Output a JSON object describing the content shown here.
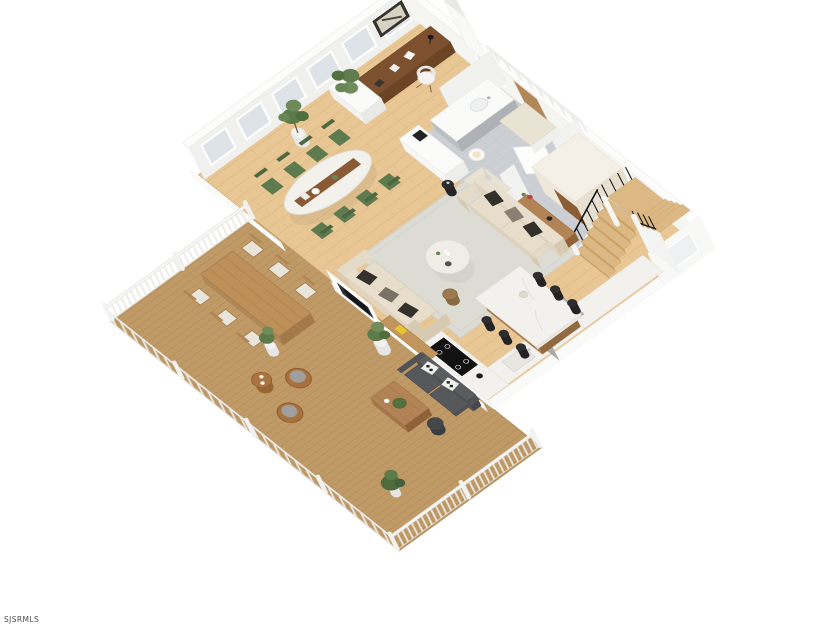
{
  "image": {
    "description": "3D dollhouse-view floor plan rendering of an open-concept main level with wraparound wood deck",
    "background": "#ffffff"
  },
  "watermark": {
    "text": "SJSRMLS"
  },
  "colors": {
    "interior_floor": "#e8c794",
    "deck_floor": "#c09a66",
    "tile_floor": "#ccd0d5",
    "wall": "#f0f0ee",
    "rug": "#dcdbd4",
    "sofa": "#e7ddcb",
    "dining_chair": "#5e7b50",
    "marble": "#f3f1ed",
    "island_wood": "#a97c4f",
    "stool": "#2e2e30",
    "stair_wood": "#dcb984",
    "appliance": "#a8aaac",
    "cooktop": "#121212",
    "outdoor_sofa": "#56585b",
    "wicker": "#a9713d",
    "plant": "#5d7a49",
    "desk_wood": "#7d5130"
  },
  "rooms": [
    {
      "name": "office-nook",
      "items": [
        "wood desk",
        "white shell chair",
        "black desk lamp",
        "framed wall art",
        "white planter box"
      ]
    },
    {
      "name": "dining-area",
      "items": [
        "oval marble table with wood runner",
        "8 green dining chairs",
        "potted fig plant"
      ]
    },
    {
      "name": "living-room",
      "items": [
        "two beige sofas",
        "dark accent pillows",
        "round marble coffee table",
        "wood console",
        "floor lamp",
        "black side table",
        "wicker pouf",
        "area rug"
      ]
    },
    {
      "name": "kitchen",
      "items": [
        "marble waterfall island",
        "6 black counter stools",
        "L-shaped counter",
        "induction cooktop",
        "sink",
        "gray refrigerator",
        "white buffet cabinet",
        "cream wardrobe cabinet"
      ]
    },
    {
      "name": "mudroom-bath",
      "items": [
        "gray tile floor",
        "gray vanity with sink",
        "two cushioned benches",
        "open door"
      ]
    },
    {
      "name": "staircase",
      "items": [
        "L-shaped wood stairs",
        "black metal balusters",
        "white stringers",
        "stair window",
        "balcony railing above"
      ]
    },
    {
      "name": "deck",
      "items": [
        "diagonal wood decking",
        "white picket railing",
        "outdoor dining table with six chairs",
        "two wicker lounge chairs",
        "round wicker side table",
        "charcoal outdoor sofa with patterned pillows",
        "slatted wood coffee table",
        "outdoor fireplace",
        "wood bar top",
        "potted plants"
      ]
    }
  ],
  "windows": {
    "left_wall_count": 6,
    "back_wall_count": 1,
    "stair_wall_count": 1
  }
}
